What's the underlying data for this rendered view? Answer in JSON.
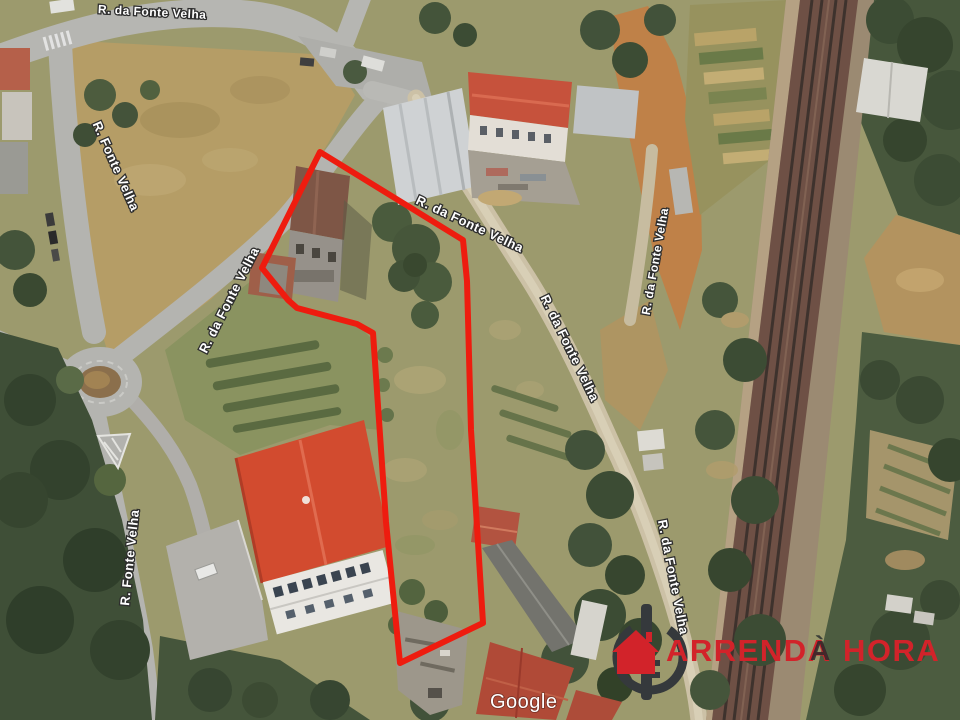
{
  "map": {
    "attribution": "Google",
    "street_labels": [
      {
        "id": "top-road",
        "text": "R. da Fonte Velha"
      },
      {
        "id": "left-road-upper",
        "text": "R. Fonte Velha"
      },
      {
        "id": "diagonal-road",
        "text": "R. da Fonte Velha"
      },
      {
        "id": "center-road",
        "text": "R. da Fonte Velha"
      },
      {
        "id": "upper-right-path",
        "text": "R. da Fonte Velha"
      },
      {
        "id": "mid-right-road",
        "text": "R. da Fonte Velha"
      },
      {
        "id": "left-road-lower",
        "text": "R. Fonte Velha"
      },
      {
        "id": "lower-right-path",
        "text": "R. da Fonte Velha"
      }
    ],
    "overlay": {
      "kind": "property-boundary",
      "color": "#ee1c0f"
    }
  },
  "watermark": {
    "word1": "ARRENDA",
    "word2": "À",
    "word3": "HORA",
    "red": "#d2232a",
    "dark": "#33383b"
  }
}
